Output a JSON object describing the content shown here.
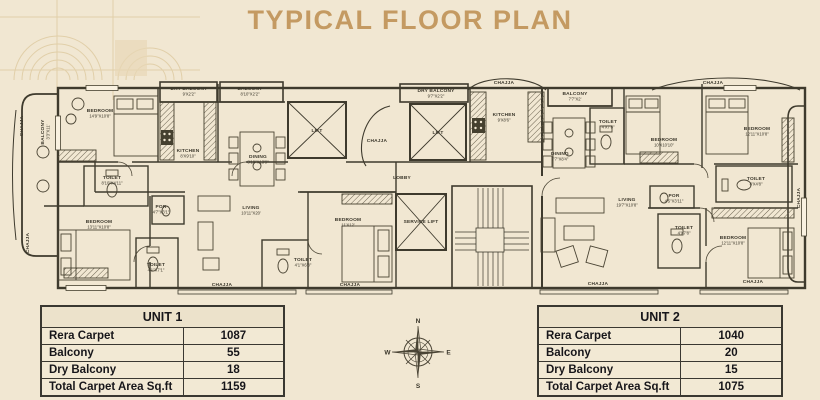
{
  "title": "TYPICAL FLOOR PLAN",
  "colors": {
    "background": "#f1e7d2",
    "title_text": "#c49a62",
    "plan_lines": "#3e3a2d",
    "table_border": "#3a3831",
    "table_text": "#17161a"
  },
  "plan": {
    "chajja": "CHAJJA",
    "lift": "LIFT",
    "lobby": "LOBBY",
    "service_lift": "SERVICE LIFT",
    "rooms": {
      "balcony_left": {
        "name": "BALCONY",
        "dims": "3'3\"X11'"
      },
      "bedroom_tl": {
        "name": "BEDROOM",
        "dims": "14'9\"X10'8\""
      },
      "dry_balcony_1": {
        "name": "DRY BALCONY",
        "dims": "9'X2'2\""
      },
      "balcony_t1": {
        "name": "BALCONY",
        "dims": "8'10\"X2'2\""
      },
      "kitchen_1": {
        "name": "KITCHEN",
        "dims": "8'X9'10\""
      },
      "dining_1": {
        "name": "DINING",
        "dims": "8'10\"X13'9\""
      },
      "toilet_1": {
        "name": "TOILET",
        "dims": "8'10\"X4'11\""
      },
      "bedroom_bl": {
        "name": "BEDROOM",
        "dims": "13'11\"X10'8\""
      },
      "por_1": {
        "name": "POR",
        "dims": "4'7\"X3'1\""
      },
      "toilet_2": {
        "name": "TOILET",
        "dims": "4'1\"X7'1\""
      },
      "living_1": {
        "name": "LIVING",
        "dims": "10'11\"X20'"
      },
      "toilet_3": {
        "name": "TOILET",
        "dims": "4'1\"X6'8\""
      },
      "bedroom_c1": {
        "name": "BEDROOM",
        "dims": "11'X12'"
      },
      "dry_balcony_2": {
        "name": "DRY BALCONY",
        "dims": "9'7\"X2'2\""
      },
      "kitchen_2": {
        "name": "KITCHEN",
        "dims": "9'X8'6\""
      },
      "balcony_t2": {
        "name": "BALCONY",
        "dims": "7'7\"X2'"
      },
      "dining_2": {
        "name": "DINING",
        "dims": "7'7\"X8'4\""
      },
      "toilet_4": {
        "name": "TOILET",
        "dims": "4'X7'8\""
      },
      "bedroom_mr": {
        "name": "BEDROOM",
        "dims": "10'X10'10\""
      },
      "bedroom_tr": {
        "name": "BEDROOM",
        "dims": "12'11\"X10'8\""
      },
      "toilet_5": {
        "name": "TOILET",
        "dims": "8'X4'8\""
      },
      "por_2": {
        "name": "POR",
        "dims": "4'5\"X3'11\""
      },
      "living_2": {
        "name": "LIVING",
        "dims": "19'7\"X10'8\""
      },
      "toilet_6": {
        "name": "TOILET",
        "dims": "4'X7'8\""
      },
      "bedroom_br": {
        "name": "BEDROOM",
        "dims": "12'11\"X10'8\""
      }
    }
  },
  "compass": {
    "north": "N",
    "south": "S",
    "east": "E",
    "west": "W"
  },
  "tables": {
    "unit1": {
      "title": "UNIT 1",
      "rows": [
        {
          "label": "Rera Carpet",
          "value": "1087"
        },
        {
          "label": "Balcony",
          "value": "55"
        },
        {
          "label": "Dry Balcony",
          "value": "18"
        },
        {
          "label": "Total Carpet Area Sq.ft",
          "value": "1159"
        }
      ]
    },
    "unit2": {
      "title": "UNIT 2",
      "rows": [
        {
          "label": "Rera Carpet",
          "value": "1040"
        },
        {
          "label": "Balcony",
          "value": "20"
        },
        {
          "label": "Dry Balcony",
          "value": "15"
        },
        {
          "label": "Total Carpet Area Sq.ft",
          "value": "1075"
        }
      ]
    }
  }
}
